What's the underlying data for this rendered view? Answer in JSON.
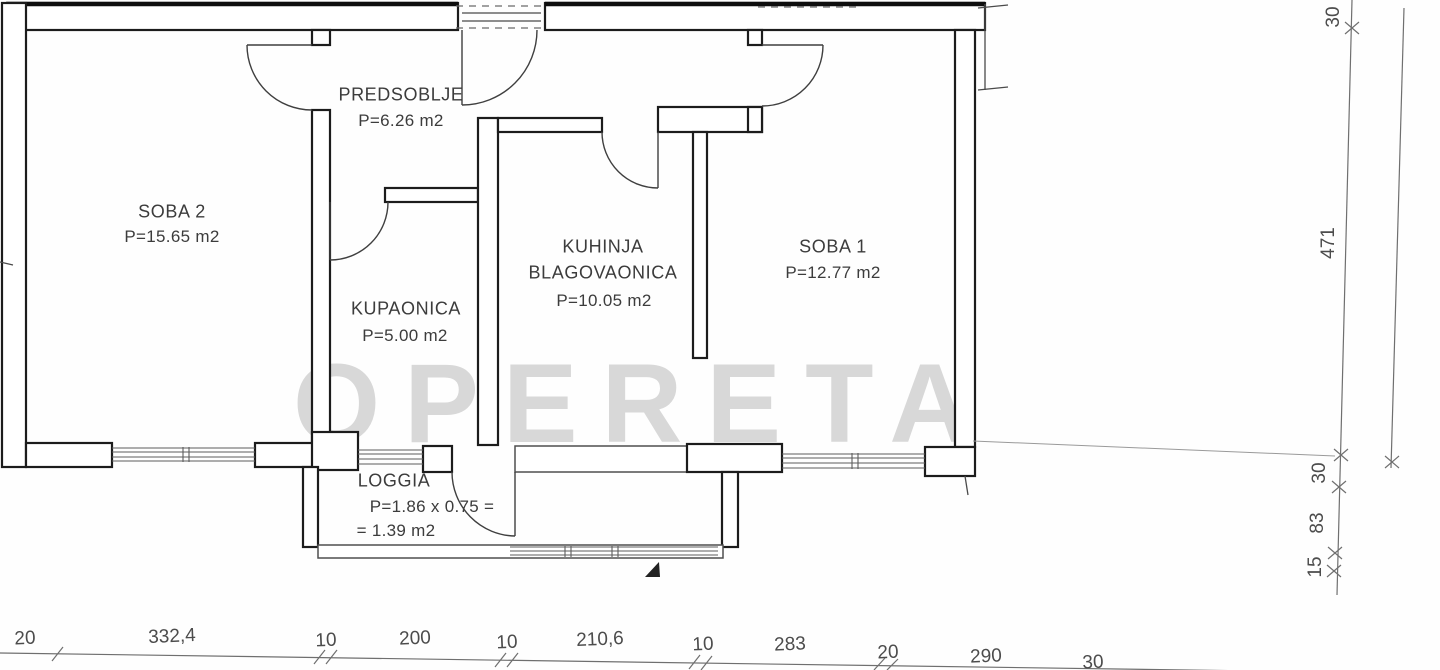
{
  "document_type": "apartment floor plan scan",
  "watermark": "OPERETA",
  "rooms": {
    "soba2": {
      "line1": "SOBA 2",
      "line2": "P=15.65 m2"
    },
    "predsoblje": {
      "line1": "PREDSOBLJE",
      "line2": "P=6.26 m2"
    },
    "kupaonica": {
      "line1": "KUPAONICA",
      "line2": "P=5.00 m2"
    },
    "kuhinja": {
      "line1": "KUHINJA",
      "line2": "BLAGOVAONICA",
      "line3": "P=10.05 m2"
    },
    "soba1": {
      "line1": "SOBA 1",
      "line2": "P=12.77 m2"
    },
    "loggia": {
      "line1": "LOGGIA",
      "line2": "P=1.86 x 0.75 =",
      "line3": "= 1.39 m2"
    }
  },
  "dimensions": {
    "bottom": [
      "20",
      "332,4",
      "10",
      "200",
      "10",
      "210,6",
      "10",
      "283",
      "20",
      "290",
      "30"
    ],
    "right": [
      "30",
      "471",
      "30",
      "83",
      "15"
    ]
  },
  "colors": {
    "ink": "#1c1c1c",
    "dimension_line": "#6f6f6f",
    "watermark": "#d2d2d2",
    "paper": "#fefefe"
  }
}
